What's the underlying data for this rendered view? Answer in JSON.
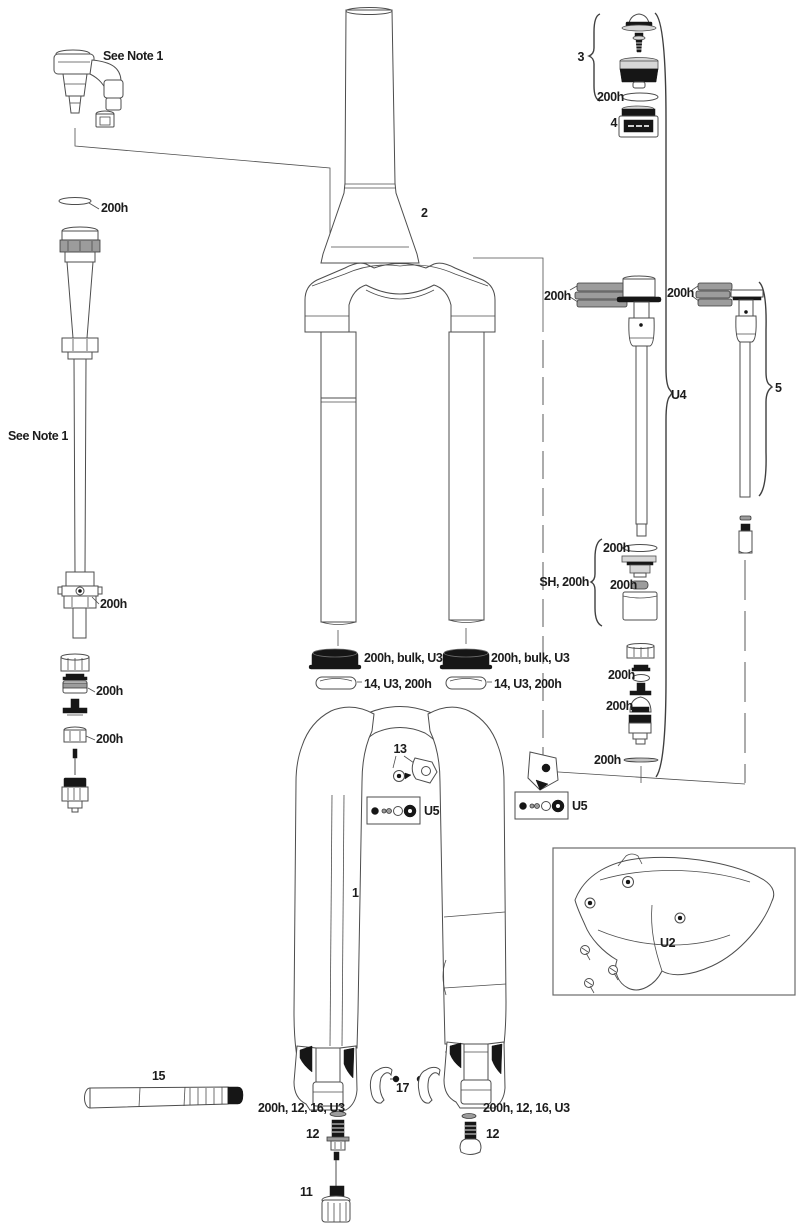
{
  "labels": {
    "note_top": "See Note 1",
    "washer_top_left": "200h",
    "note_left": "See Note 1",
    "seal_head_left": "200h",
    "piston_left": "200h",
    "nut_left": "200h",
    "steerer": "2",
    "air_top_cap_group": "3",
    "air_top_cap_oring": "200h",
    "air_valve_cap": "4",
    "u4_glide_rings": "200h",
    "u4_group": "U4",
    "spring_glide_rings": "200h",
    "spring_group": "5",
    "sh_group": "SH, 200h",
    "sh_oring_top": "200h",
    "sh_oring_bottom": "200h",
    "rebound_shims": "200h",
    "rebound_dome": "200h",
    "rebound_washer": "200h",
    "dust_seal_left": "200h, bulk, U3",
    "foam_ring_left": "14, U3, 200h",
    "dust_seal_right": "200h, bulk, U3",
    "foam_ring_right": "14, U3, 200h",
    "fender_bolt": "13",
    "u5_left": "U5",
    "u5_right": "U5",
    "lowers": "1",
    "fender_group": "U2",
    "axle": "15",
    "hose_guides": "17",
    "shaft_washer_left": "200h, 12, 16, U3",
    "shaft_bolt_left": "12",
    "shaft_washer_right": "200h, 12, 16, U3",
    "shaft_bolt_right": "12",
    "rebound_knob": "11"
  }
}
